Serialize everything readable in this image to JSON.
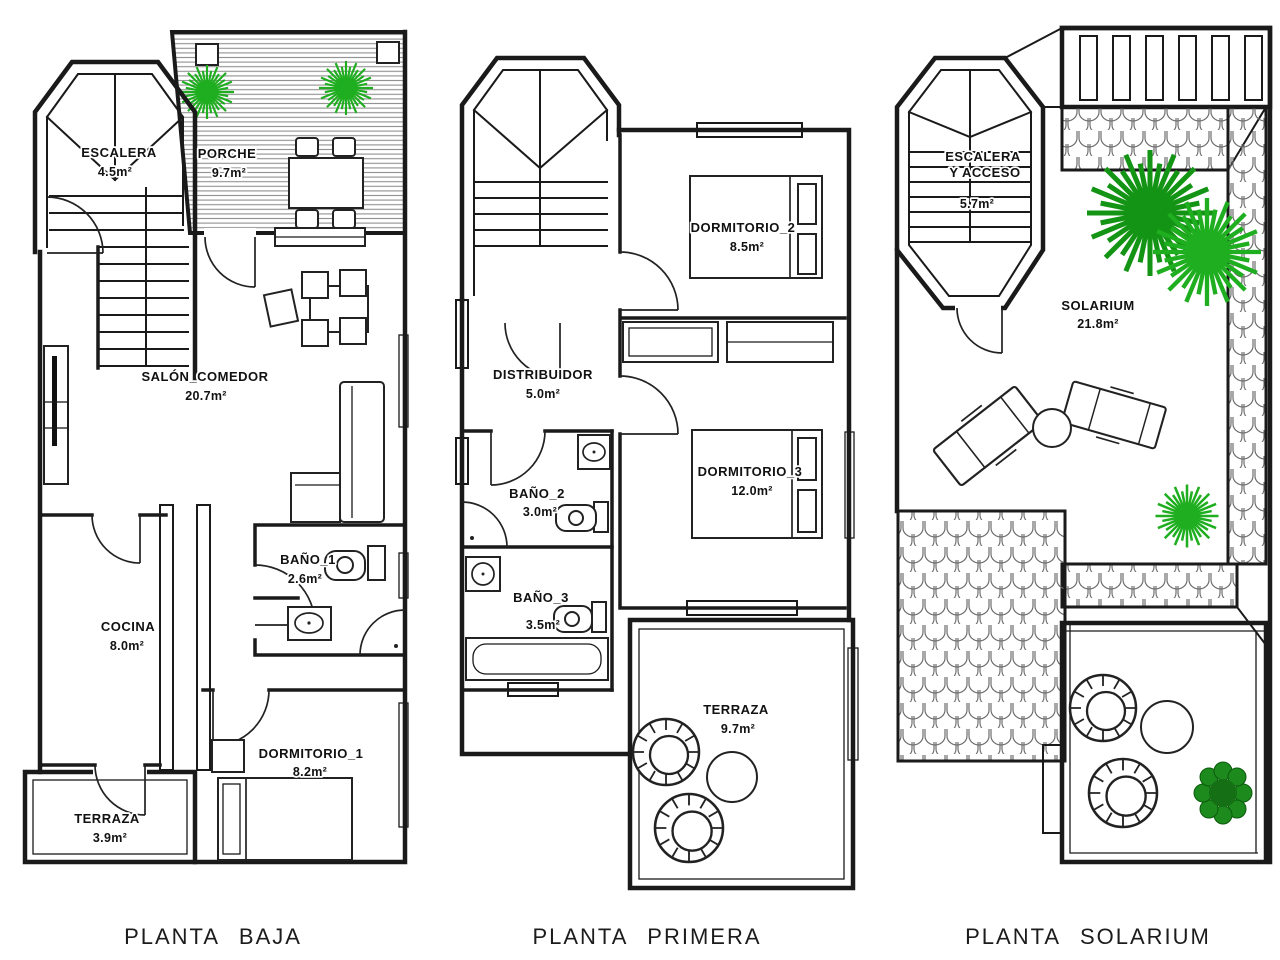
{
  "document": {
    "type": "architectural-floor-plans",
    "background": "#ffffff",
    "colors": {
      "wall": "#1a1a1a",
      "hatch": "#8f8f8f",
      "roof_tile": "#6e6e6e",
      "plant_bright": "#1fae1f",
      "plant_dark": "#149414",
      "text": "#111111"
    }
  },
  "plans": [
    {
      "title": "PLANTA BAJA",
      "rooms": {
        "escalera": {
          "name": "ESCALERA",
          "area": "4.5m²"
        },
        "porche": {
          "name": "PORCHE",
          "area": "9.7m²"
        },
        "salon": {
          "name": "SALÓN_COMEDOR",
          "area": "20.7m²"
        },
        "bano1": {
          "name": "BAÑO_1",
          "area": "2.6m²"
        },
        "cocina": {
          "name": "COCINA",
          "area": "8.0m²"
        },
        "dormitorio1": {
          "name": "DORMITORIO_1",
          "area": "8.2m²"
        },
        "terraza": {
          "name": "TERRAZA",
          "area": "3.9m²"
        }
      }
    },
    {
      "title": "PLANTA PRIMERA",
      "rooms": {
        "dormitorio2": {
          "name": "DORMITORIO_2",
          "area": "8.5m²"
        },
        "distribuidor": {
          "name": "DISTRIBUIDOR",
          "area": "5.0m²"
        },
        "dormitorio3": {
          "name": "DORMITORIO_3",
          "area": "12.0m²"
        },
        "bano2": {
          "name": "BAÑO_2",
          "area": "3.0m²"
        },
        "bano3": {
          "name": "BAÑO_3",
          "area": "3.5m²"
        },
        "terraza": {
          "name": "TERRAZA",
          "area": "9.7m²"
        }
      }
    },
    {
      "title": "PLANTA SOLARIUM",
      "rooms": {
        "escalera": {
          "name": "ESCALERA",
          "name_line2": "Y ACCESO",
          "area": "5.7m²"
        },
        "solarium": {
          "name": "SOLARIUM",
          "area": "21.8m²"
        }
      }
    }
  ]
}
